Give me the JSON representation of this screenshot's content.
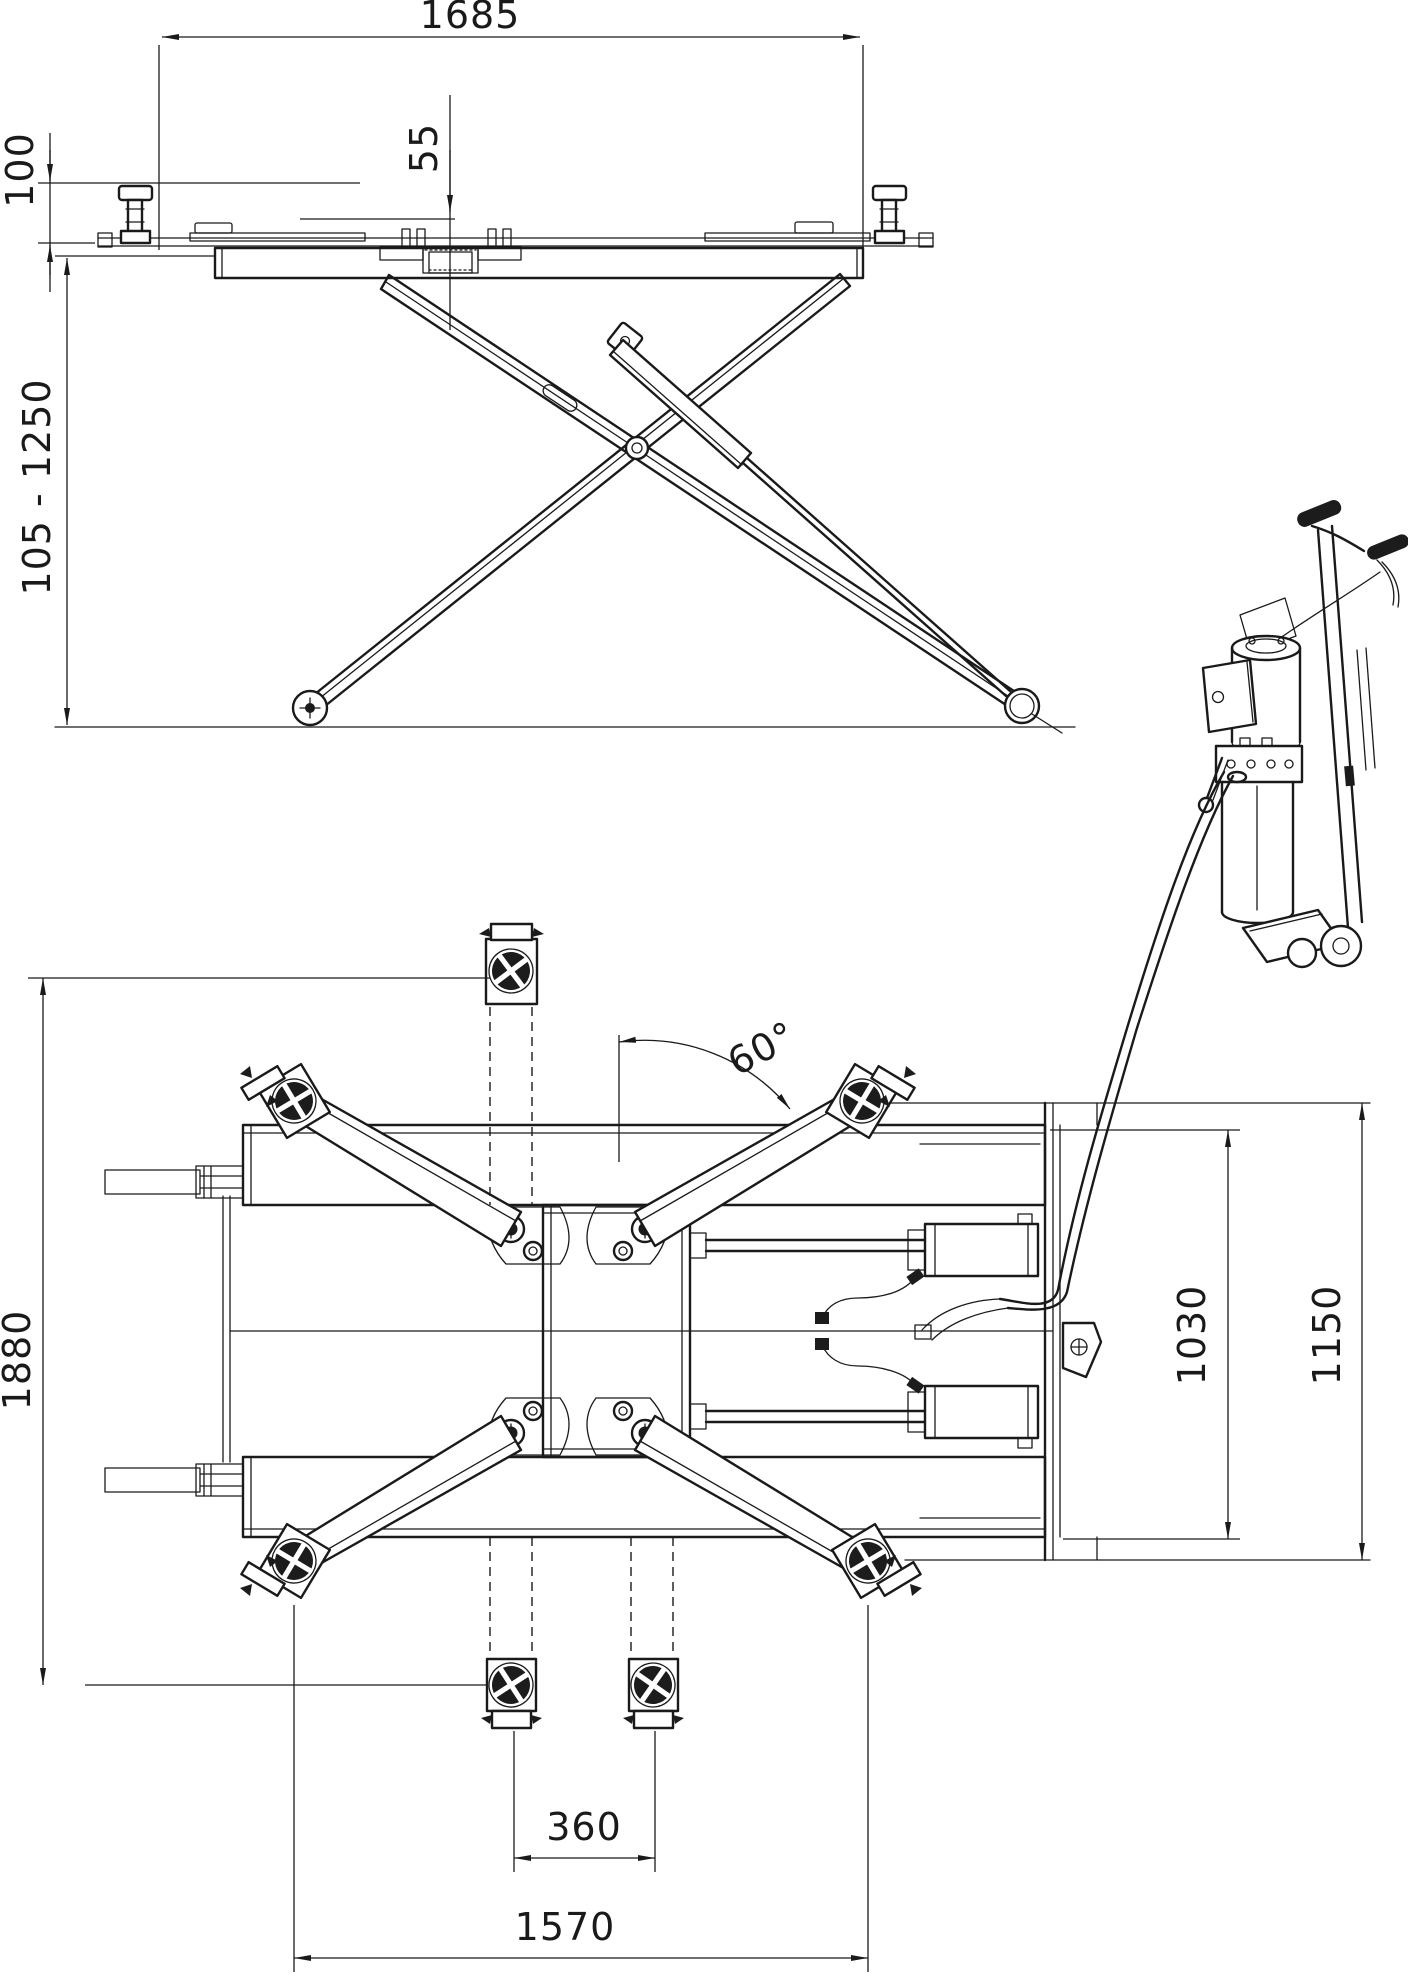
{
  "drawing": {
    "colors": {
      "ink": "#1a1a1a",
      "paper": "#ffffff"
    },
    "dimensions": {
      "side_view": {
        "platform_length": "1685",
        "pad_recess_depth": "55",
        "pad_height": "100",
        "lift_height_range": "105 - 1250"
      },
      "plan_view": {
        "overall_width": "1880",
        "arm_swing_angle": "60°",
        "base_inner_width": "1030",
        "base_overall_width": "1150",
        "pad_inner_spacing": "360",
        "pad_outer_spacing": "1570"
      }
    }
  }
}
